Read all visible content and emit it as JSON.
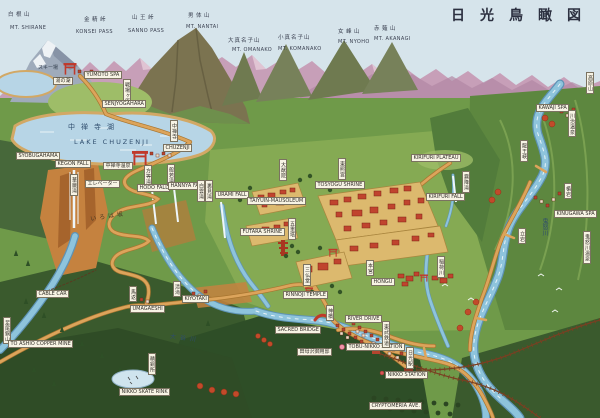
{
  "title": "日光鳥瞰図",
  "palette": {
    "sky": "#d6e4eb",
    "water": "#8ec4dc",
    "road": "#dca45b",
    "shrine_red": "#c0442e",
    "forest": "#3a5a2d",
    "label_paper": "#f7f3e4"
  },
  "peaks": [
    {
      "ja": "白根山",
      "en": "MT. SHIRANE"
    },
    {
      "ja": "金精峠",
      "en": "KONSEI PASS"
    },
    {
      "ja": "山王峠",
      "en": "SANNO PASS"
    },
    {
      "ja": "男体山",
      "en": "MT. NANTAI"
    },
    {
      "ja": "大真名子山",
      "en": "MT. OMANAKO"
    },
    {
      "ja": "小真名子山",
      "en": "MT. KOMANAKO"
    },
    {
      "ja": "女峰山",
      "en": "MT. NYOHO"
    },
    {
      "ja": "赤薙山",
      "en": "MT. AKANAGI"
    }
  ],
  "lakes": {
    "chuzenji_ja": "中禅寺湖",
    "chuzenji_en": "LAKE CHUZENJI",
    "yunoko": "湯の湖"
  },
  "rivers": {
    "daiya": "大谷川",
    "kinu": "鬼怒川",
    "inari": "稲荷川"
  },
  "yumoto": {
    "spa_en": "YUMOTO SPA",
    "ski": "スキー場"
  },
  "senjogahara": {
    "ja": "戦場ヶ原",
    "en": "SENJYOGAHARA"
  },
  "chuzenji": {
    "town_ja": "中禅寺",
    "town_en": "CHUZENJI",
    "spa": "中禅寺温泉",
    "hama": "SYOBUGAHAMA"
  },
  "falls": {
    "kegon_ja": "華厳滝",
    "kegon_en": "KEGON FALL",
    "elevator": "エレベーター",
    "hodo_ja": "方等滝",
    "hodo_en": "HODO FALL",
    "hannya_ja": "般若滝",
    "hannya_en": "HANNYA FALL",
    "shirakumo_ja": "白雲滝",
    "urami_ja": "裏見滝",
    "urami_en": "URAMI FALL",
    "kirifuri_ja": "霧降滝",
    "kirifuri_en": "KIRIFURI FALL"
  },
  "roads": {
    "irohazaka": "いろは坂",
    "river_drive": "RIVER DRIVE",
    "cryptomeria": "CRYPTOMERIA AVE.",
    "cable_car": "CABLE CAR",
    "ashio_ja": "足尾銅山",
    "ashio_en": "TO ASHIO COPPER MINE"
  },
  "shrines": {
    "taiyuin_ja": "大猷院",
    "taiyuin_en": "TAIYUIN-MAUSOLEUM",
    "tosyogu_ja": "東照宮",
    "tosyogu_en": "TOSYOGU SHRINE",
    "pagoda_ja": "五重塔",
    "futara_en": "FUTARA SHRINE",
    "sanbutsudo_ja": "三仏堂",
    "rinnoji_en": "RINNOJI TEMPLE",
    "hongu_ja": "本宮",
    "hongu_en": "HONGU",
    "shinkyo_ja": "神橋",
    "shinkyo_en": "SACRED BRIDGE",
    "tamozawa": "田母沢御用邸"
  },
  "towns": {
    "umagaeshi_ja": "馬返",
    "umagaeshi_en": "UMAGAESHI",
    "kiyotaki_ja": "清滝",
    "kiyotaki_en": "KIYOTAKI",
    "seidosho": "精銅所",
    "skate_rink": "NIKKO SKATE RINK",
    "tobu_station": "TOBU-NIKKO STATION",
    "tobu_rail": "東武鉄道",
    "nikko_sta_ja": "日光駅",
    "nikko_station": "NIKKO STATION"
  },
  "east": {
    "kirifuri_plateau": "KIRIFURI PLATEAU",
    "kawaji_spa": "KAWAJI SPA",
    "kawaji_ja": "川治温泉",
    "takahara_ja": "高原山",
    "ryuokyo_ja": "龍王峡",
    "tateiwa_ja": "楯岩",
    "tachiiwa_ja": "立岩",
    "kinugawa_spa": "KINUGAWA SPA",
    "kinugawa_ja": "鬼怒川温泉"
  }
}
